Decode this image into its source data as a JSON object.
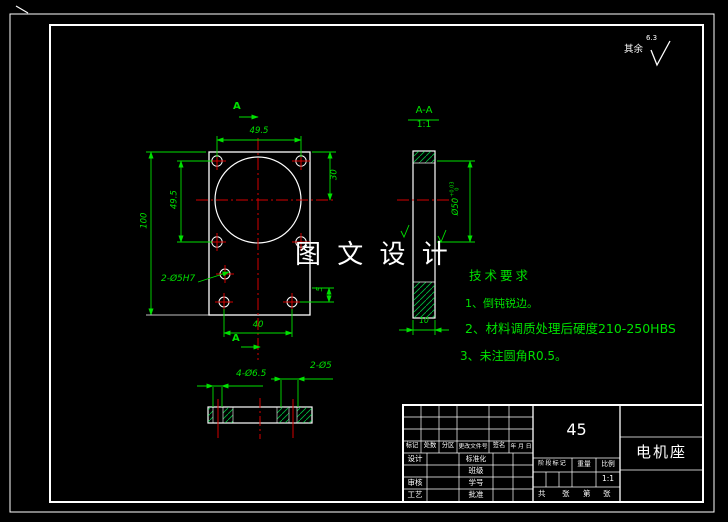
{
  "watermark": "图 文 设 计",
  "surface_finish": {
    "label": "其余",
    "roughness": "6.3"
  },
  "front_view": {
    "section_letter_top": "A",
    "section_letter_bottom": "A",
    "dim_hole_spacing_h": "49.5",
    "dim_hole_spacing_v": "49.5",
    "dim_overall_height": "100",
    "dim_top_to_center": "30",
    "dim_small": "5",
    "dim_bottom_holes": "40",
    "hole_callout": "2-Ø5H7"
  },
  "section_view": {
    "title": "A-A",
    "scale": "1:1",
    "bore": "Ø50",
    "bore_tol_upper": "+0.03",
    "bore_tol_lower": "0",
    "dim_thickness": "10"
  },
  "bottom_view": {
    "callout_large": "4-Ø6.5",
    "callout_small": "2-Ø5"
  },
  "tech_requirements": {
    "title": "技术要求",
    "items": [
      "1、倒钝锐边。",
      "2、材料调质处理后硬度210-250HBS",
      "3、未注圆角R0.5。"
    ]
  },
  "title_block": {
    "material": "45",
    "part_name": "电机座",
    "header_cells": [
      "标记",
      "处数",
      "分区",
      "更改文件号",
      "签名",
      "年 月 日"
    ],
    "row_labels_left": [
      "设计",
      "",
      "审核",
      "工艺"
    ],
    "row_labels_mid": [
      "标准化",
      "班级",
      "学号",
      "批准"
    ],
    "stage_headers": [
      "阶段标记",
      "重量",
      "比例"
    ],
    "scale_value": "1:1",
    "sheet_row": [
      "共",
      "张",
      "第",
      "张"
    ]
  },
  "colors": {
    "background": "#000000",
    "outline": "#ffffff",
    "dimension": "#00e000",
    "centerline": "#d40000"
  }
}
